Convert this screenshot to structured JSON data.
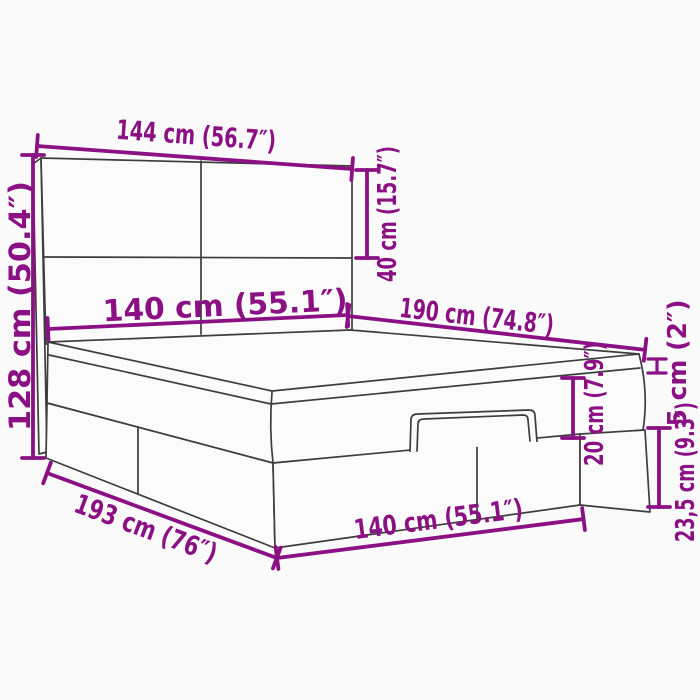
{
  "diagram": {
    "type": "product-dimension-diagram",
    "subject": "ottoman-storage-bed-with-headboard",
    "background_color": "#fafafa",
    "accent_color": "#8b1084",
    "outline_color": "#3d3d3d"
  },
  "labels": {
    "headboard_width": "144 cm (56.7″)",
    "total_height": "128 cm (50.4″)",
    "headboard_top_height": "40 cm (15.7″)",
    "mattress_width": "140 cm (55.1″)",
    "mattress_length": "190 cm (74.8″)",
    "topper_thickness": "5 cm (2″)",
    "mattress_thickness": "20 cm (7.9″)",
    "base_height": "23,5 cm (9.3″)",
    "total_length": "193 cm (76″)",
    "base_width": "140 cm (55.1″)"
  }
}
